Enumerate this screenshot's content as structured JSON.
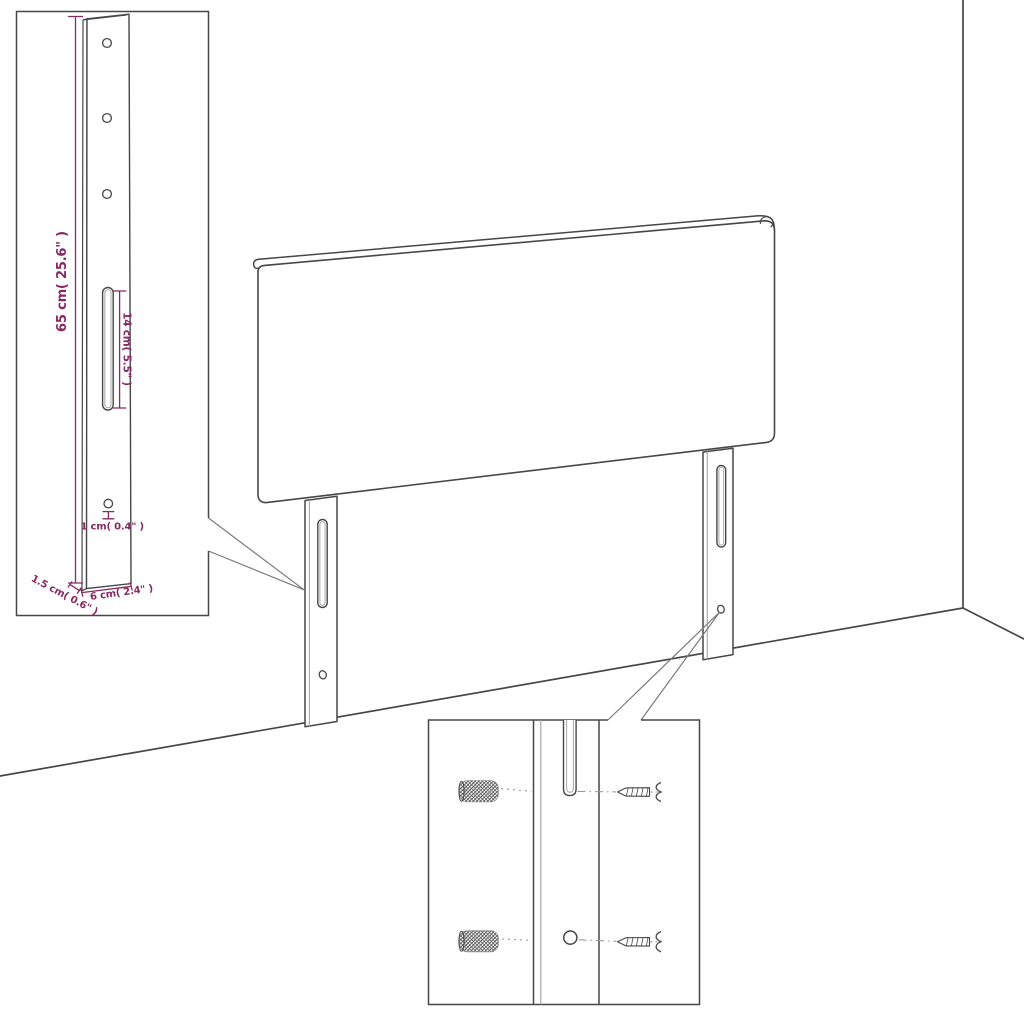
{
  "page": {
    "background": "#ffffff",
    "description": "Line-art assembly diagram: upholstered headboard with two slotted mounting legs standing in a room corner, a dimensioned leg detail inset at top left, and a wall-fixing hardware inset at bottom center."
  },
  "colors": {
    "line": "#474747",
    "line_light": "#a8a8a8",
    "leader": "#7a7a7a",
    "dash": "#9a9a9a",
    "dimension": "#872a64",
    "background": "#ffffff"
  },
  "leg_detail_inset": {
    "dimension_labels": {
      "leg_height": "65 cm( 25.6\" )",
      "slot_length": "14 cm( 5.5\" )",
      "hole_diameter": "1 cm( 0.4\" )",
      "leg_thickness": "1.5 cm( 0.6\" )",
      "leg_width": "6 cm( 2.4\" )"
    }
  },
  "mounting_detail_inset": {
    "hardware_icons": [
      "wall-plug",
      "screw"
    ],
    "rows": [
      {
        "left": "wall plug",
        "center": "leg slot",
        "right": "screw"
      },
      {
        "left": "wall plug",
        "center": "leg hole",
        "right": "screw"
      }
    ]
  }
}
